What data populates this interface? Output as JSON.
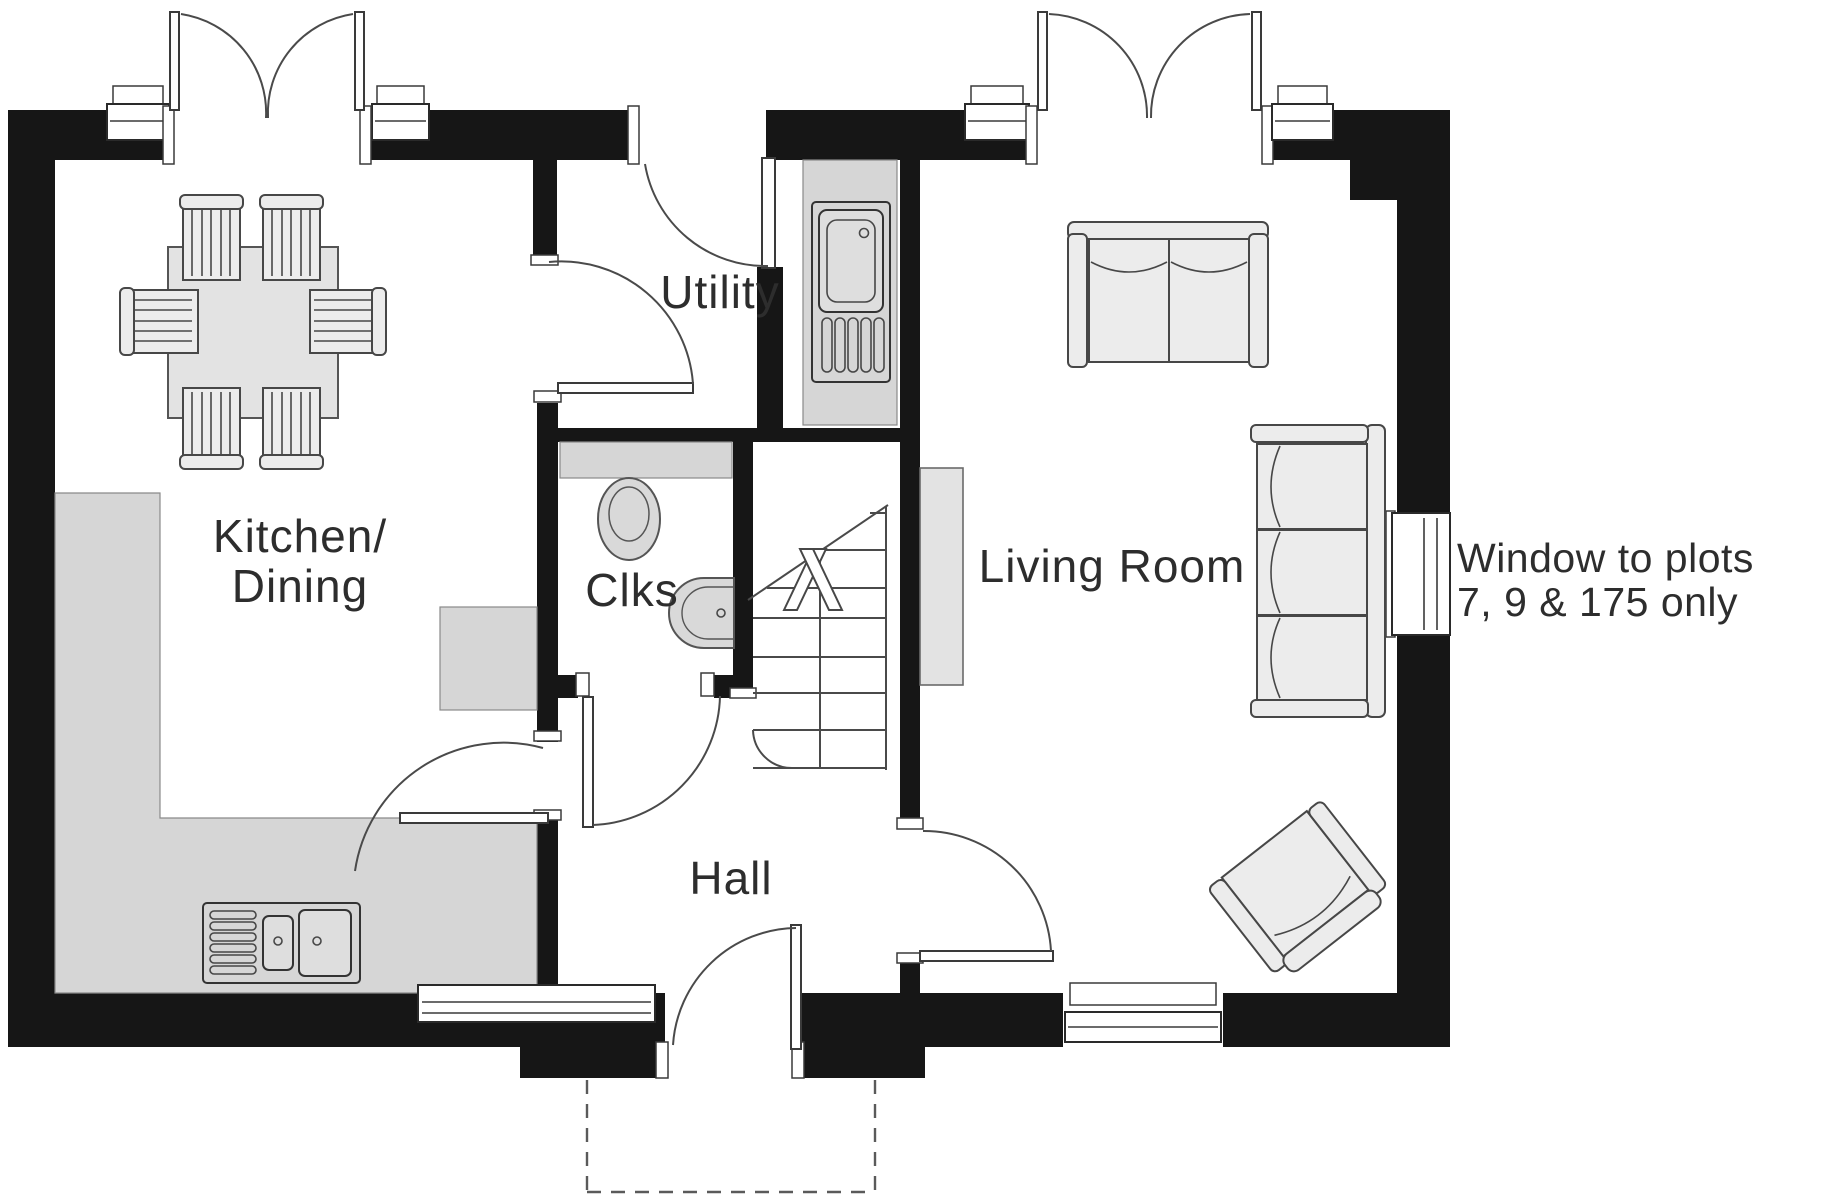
{
  "rooms": {
    "kitchen_dining": {
      "line1": "Kitchen/",
      "line2": "Dining"
    },
    "utility": {
      "label": "Utility"
    },
    "cloakroom": {
      "label": "Clks"
    },
    "hall": {
      "label": "Hall"
    },
    "living_room": {
      "label": "Living Room"
    }
  },
  "annotation": {
    "line1": "Window to plots",
    "line2": "7, 9 & 175 only"
  },
  "colors": {
    "wall": "#161616",
    "counter": "#d6d6d6",
    "furniture_fill": "#ececec",
    "outline": "#4a4a4a",
    "text": "#2d2d2d",
    "background": "#ffffff"
  },
  "icons": {
    "dining-table-icon": "gray rectangle with 6 striped chairs",
    "kitchen-sink-icon": "double bowl sink with drainer",
    "utility-sink-icon": "single bowl sink with drainer",
    "toilet-icon": "oval pan with seat",
    "basin-icon": "half-round hand basin",
    "sofa-2-seat-icon": "two cushion sofa",
    "sofa-3-seat-icon": "three cushion sofa",
    "armchair-icon": "rotated single armchair",
    "stairs-icon": "straight flight with up arrow and break line",
    "front-door-icon": "single swing door with dashed canopy"
  }
}
